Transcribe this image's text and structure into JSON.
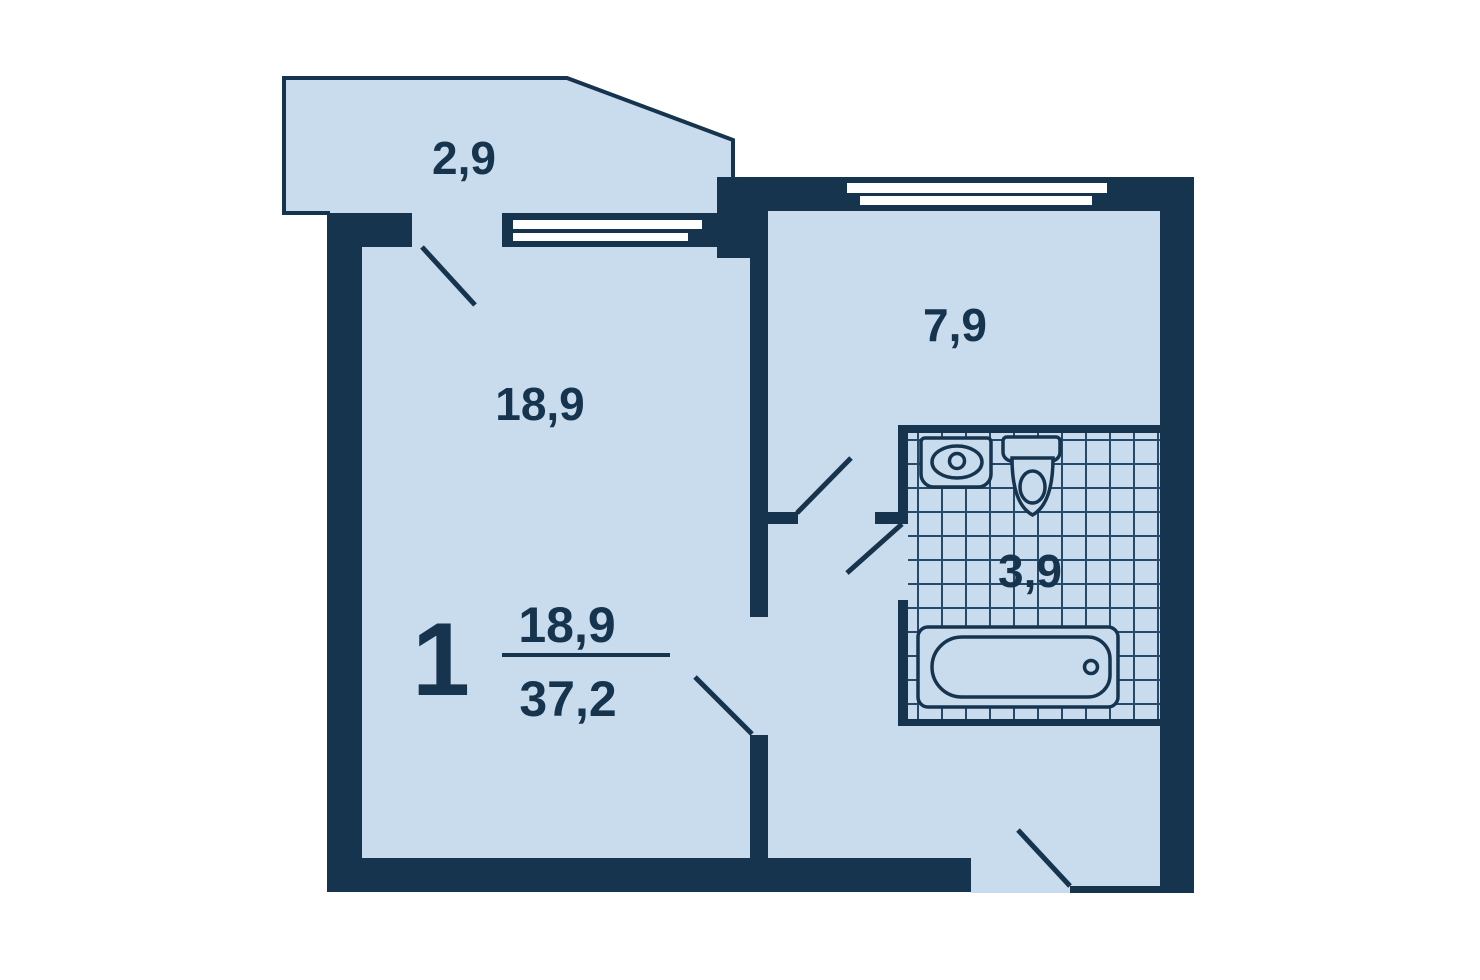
{
  "plan": {
    "type": "apartment-floor-plan",
    "rooms": [
      {
        "id": "balcony",
        "area_label": "2,9"
      },
      {
        "id": "living-room",
        "area_label": "18,9"
      },
      {
        "id": "kitchen",
        "area_label": "7,9"
      },
      {
        "id": "bathroom",
        "area_label": "3,9"
      }
    ],
    "summary": {
      "rooms_count": "1",
      "living_area": "18,9",
      "total_area": "37,2"
    },
    "fixtures": [
      "sink",
      "toilet",
      "bathtub"
    ],
    "colors": {
      "wall": "#16344E",
      "floor": "#C9DCEE",
      "window": "#FFFFFF",
      "tile_line": "#24496B"
    }
  }
}
